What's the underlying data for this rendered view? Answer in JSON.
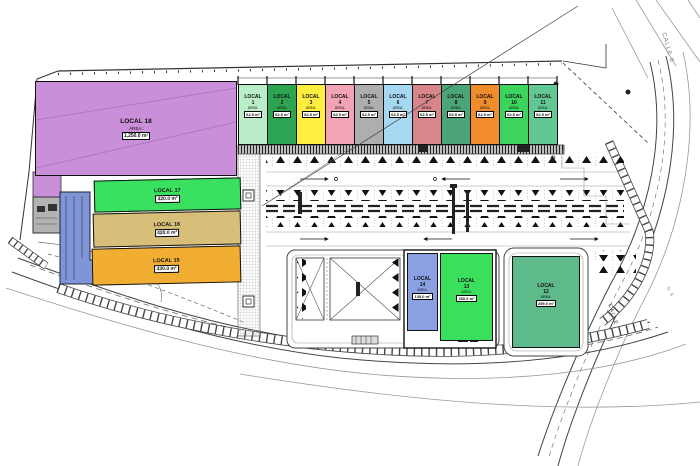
{
  "units_top": [
    {
      "name": "LOCAL",
      "number": "1",
      "area_label": "ÁREA:",
      "area": "62.5 m²",
      "color": "#b9eec9"
    },
    {
      "name": "LOCAL",
      "number": "2",
      "area_label": "ÁREA:",
      "area": "62.5 m²",
      "color": "#2ca452"
    },
    {
      "name": "LOCAL",
      "number": "3",
      "area_label": "ÁREA:",
      "area": "62.5 m²",
      "color": "#ffee40"
    },
    {
      "name": "LOCAL",
      "number": "4",
      "area_label": "ÁREA:",
      "area": "62.5 m²",
      "color": "#f3a3b6"
    },
    {
      "name": "LOCAL",
      "number": "5",
      "area_label": "ÁREA:",
      "area": "62.5 m²",
      "color": "#aeaeae"
    },
    {
      "name": "LOCAL",
      "number": "6",
      "area_label": "ÁREA:",
      "area": "62.5 m²",
      "color": "#a7d8f2"
    },
    {
      "name": "LOCAL",
      "number": "7",
      "area_label": "ÁREA:",
      "area": "62.5 m²",
      "color": "#d8868c"
    },
    {
      "name": "LOCAL",
      "number": "8",
      "area_label": "ÁREA:",
      "area": "62.5 m²",
      "color": "#4ba578"
    },
    {
      "name": "LOCAL",
      "number": "9",
      "area_label": "ÁREA:",
      "area": "62.5 m²",
      "color": "#f18c2d"
    },
    {
      "name": "LOCAL",
      "number": "10",
      "area_label": "ÁREA:",
      "area": "62.5 m²",
      "color": "#3cd35f"
    },
    {
      "name": "LOCAL",
      "number": "11",
      "area_label": "ÁREA:",
      "area": "62.5 m²",
      "color": "#62c793"
    }
  ],
  "units_left": [
    {
      "name": "LOCAL",
      "number": "18",
      "area_label": "ÁREA:",
      "area": "1,250.0 m²",
      "color": "#c98fd8"
    },
    {
      "name": "LOCAL",
      "number": "17",
      "area_label": "ÁREA:",
      "area": "420.0 m²",
      "color": "#3ae05f"
    },
    {
      "name": "LOCAL",
      "number": "16",
      "area_label": "ÁREA:",
      "area": "420.0 m²",
      "color": "#d8bf79"
    },
    {
      "name": "LOCAL",
      "number": "15",
      "area_label": "ÁREA:",
      "area": "430.0 m²",
      "color": "#f2ae33"
    }
  ],
  "units_bottom": [
    {
      "name": "LOCAL",
      "number": "14",
      "area_label": "ÁREA:",
      "area": "135.0 m²",
      "color": "#8b9fe3"
    },
    {
      "name": "LOCAL",
      "number": "13",
      "area_label": "ÁREA:",
      "area": "260.0 m²",
      "color": "#3ae05c"
    },
    {
      "name": "LOCAL",
      "number": "12",
      "area_label": "ÁREA:",
      "area": "255.0 m²",
      "color": "#5eba8b"
    }
  ],
  "road_labels": {
    "top_right": "CALLE 6",
    "right": "CALLE",
    "bearing": "N 8"
  },
  "annex": {
    "ramp_color": "#8095d8",
    "utility_color": "#b3b3b3",
    "plan_line_color": "#333333"
  }
}
